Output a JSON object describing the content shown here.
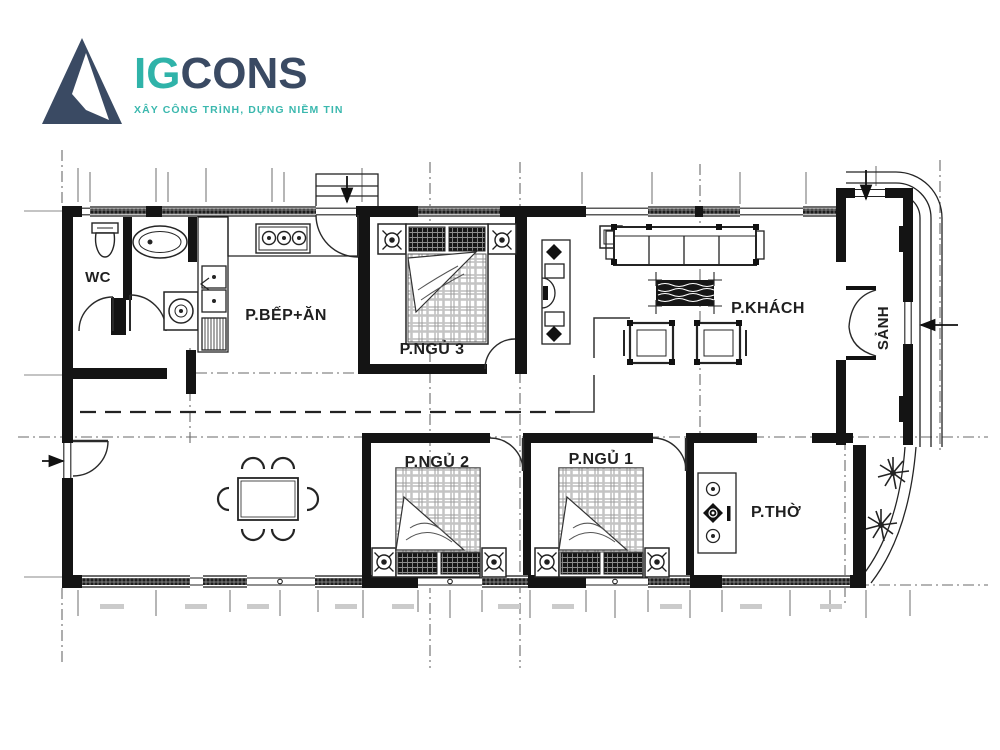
{
  "logo": {
    "brand_prefix": "IG",
    "brand_suffix": "CONS",
    "tagline": "XÂY CÔNG TRÌNH, DỰNG NIỀM TIN",
    "colors": {
      "navy": "#3a4a63",
      "teal": "#2fb3a9"
    }
  },
  "plan": {
    "ink": "#1c1c1c",
    "rooms": [
      {
        "id": "wc",
        "label": "WC"
      },
      {
        "id": "kitchen",
        "label": "P.BẾP+ĂN"
      },
      {
        "id": "bedroom3",
        "label": "P.NGỦ 3"
      },
      {
        "id": "living",
        "label": "P.KHÁCH"
      },
      {
        "id": "hall",
        "label": "SẢNH"
      },
      {
        "id": "bedroom2",
        "label": "P.NGỦ 2"
      },
      {
        "id": "bedroom1",
        "label": "P.NGỦ 1"
      },
      {
        "id": "worship",
        "label": "P.THỜ"
      }
    ]
  }
}
